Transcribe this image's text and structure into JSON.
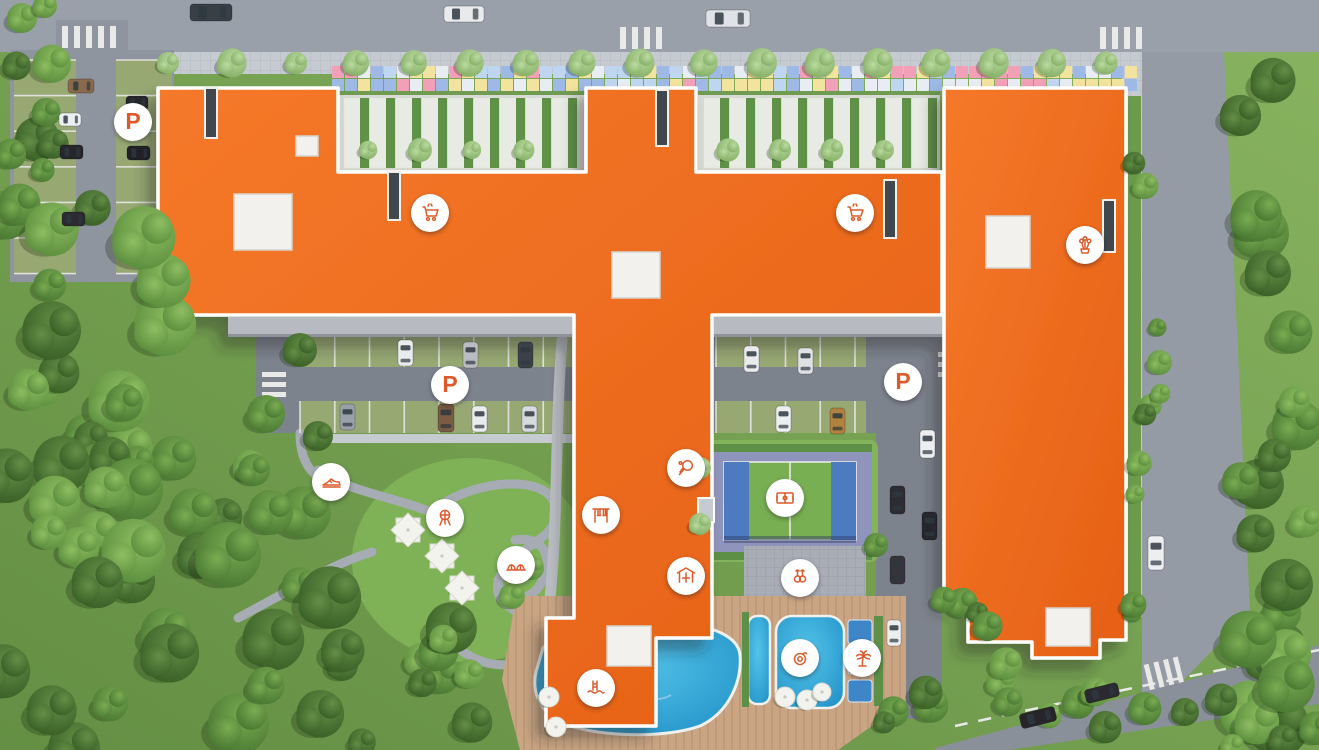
{
  "scene": {
    "type": "residential-complex-aerial-masterplan",
    "colors": {
      "building_roof": "#EE6B22",
      "building_roof_dark": "#DE5A12",
      "marker_bg": "#FFFFFF",
      "marker_glyph": "#DC5B2C",
      "road": "#9AA0A9",
      "inner_drive": "#7D838D",
      "sidewalk": "#C6CAD1",
      "grass": "#79A754",
      "pool_water": "#2EA5D9",
      "court_green": "#79AF53",
      "court_blue": "#4D7BC0",
      "deck_wood": "#C9A584",
      "mosaic_palette": [
        "#BFD6F0",
        "#F2A0B8",
        "#F2E39E",
        "#9FB9E6",
        "#E8EDF4"
      ]
    },
    "markers": [
      {
        "id": "parking-northwest",
        "icon": "parking-badge",
        "label": "P",
        "x": 133,
        "y": 122
      },
      {
        "id": "parking-central",
        "icon": "parking-badge",
        "label": "P",
        "x": 450,
        "y": 385
      },
      {
        "id": "parking-east",
        "icon": "parking-badge",
        "label": "P",
        "x": 903,
        "y": 382
      },
      {
        "id": "supermarket-west",
        "icon": "shopping-cart-icon",
        "x": 430,
        "y": 213
      },
      {
        "id": "supermarket-east",
        "icon": "shopping-cart-icon",
        "x": 855,
        "y": 213
      },
      {
        "id": "flower-shop",
        "icon": "flower-shop-icon",
        "x": 1085,
        "y": 245
      },
      {
        "id": "jogging-track",
        "icon": "sneaker-icon",
        "x": 331,
        "y": 482
      },
      {
        "id": "table-tennis",
        "icon": "table-tennis-icon",
        "x": 686,
        "y": 468
      },
      {
        "id": "swings",
        "icon": "swings-icon",
        "x": 601,
        "y": 515
      },
      {
        "id": "sports-court",
        "icon": "sports-field-icon",
        "x": 785,
        "y": 498
      },
      {
        "id": "bbq-area",
        "icon": "bbq-grill-icon",
        "x": 445,
        "y": 518
      },
      {
        "id": "playground",
        "icon": "playground-icon",
        "x": 516,
        "y": 565
      },
      {
        "id": "gazebo",
        "icon": "gazebo-icon",
        "x": 686,
        "y": 576
      },
      {
        "id": "outdoor-gym",
        "icon": "gym-rings-icon",
        "x": 800,
        "y": 578
      },
      {
        "id": "swimming-pool",
        "icon": "pool-ladder-icon",
        "x": 596,
        "y": 688
      },
      {
        "id": "kids-pool",
        "icon": "swim-ring-icon",
        "x": 800,
        "y": 658
      },
      {
        "id": "palm-lounge",
        "icon": "palm-tree-icon",
        "x": 862,
        "y": 658
      }
    ]
  }
}
